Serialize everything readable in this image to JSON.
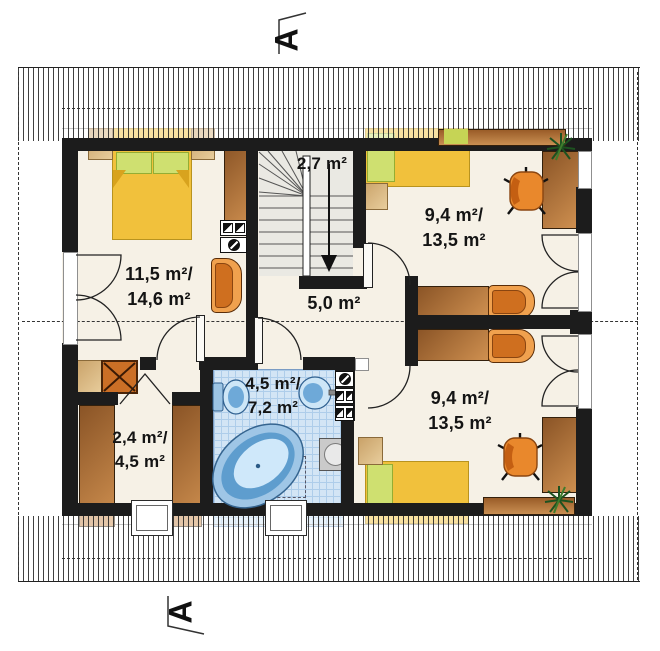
{
  "plan": {
    "section_marker": "A",
    "rooms": {
      "bedroom_left": {
        "area_line1": "11,5 m²/",
        "area_line2": "14,6 m²"
      },
      "staircase": {
        "area_line1": "2,7 m²"
      },
      "bedroom_top_right": {
        "area_line1": "9,4 m²/",
        "area_line2": "13,5 m²"
      },
      "hallway": {
        "area_line1": "5,0 m²"
      },
      "bathroom": {
        "area_line1": "4,5 m²/",
        "area_line2": "7,2 m²"
      },
      "closet": {
        "area_line1": "2,4 m²/",
        "area_line2": "4,5 m²"
      },
      "bedroom_bottom_right": {
        "area_line1": "9,4 m²/",
        "area_line2": "13,5 m²"
      }
    },
    "colors": {
      "floor": "#f6f1e6",
      "wall": "#1c1c1c",
      "bed_yellow": "#f1c13c",
      "pillow_green": "#cfe070",
      "furniture_orange": "#e8872b",
      "wood_brown": "#a5642c",
      "bath_tile": "#d3e5f5",
      "fixture_blue": "#7fb2dc",
      "plant_green": "#1e5c1e",
      "table_tan": "#d9b98c"
    }
  }
}
